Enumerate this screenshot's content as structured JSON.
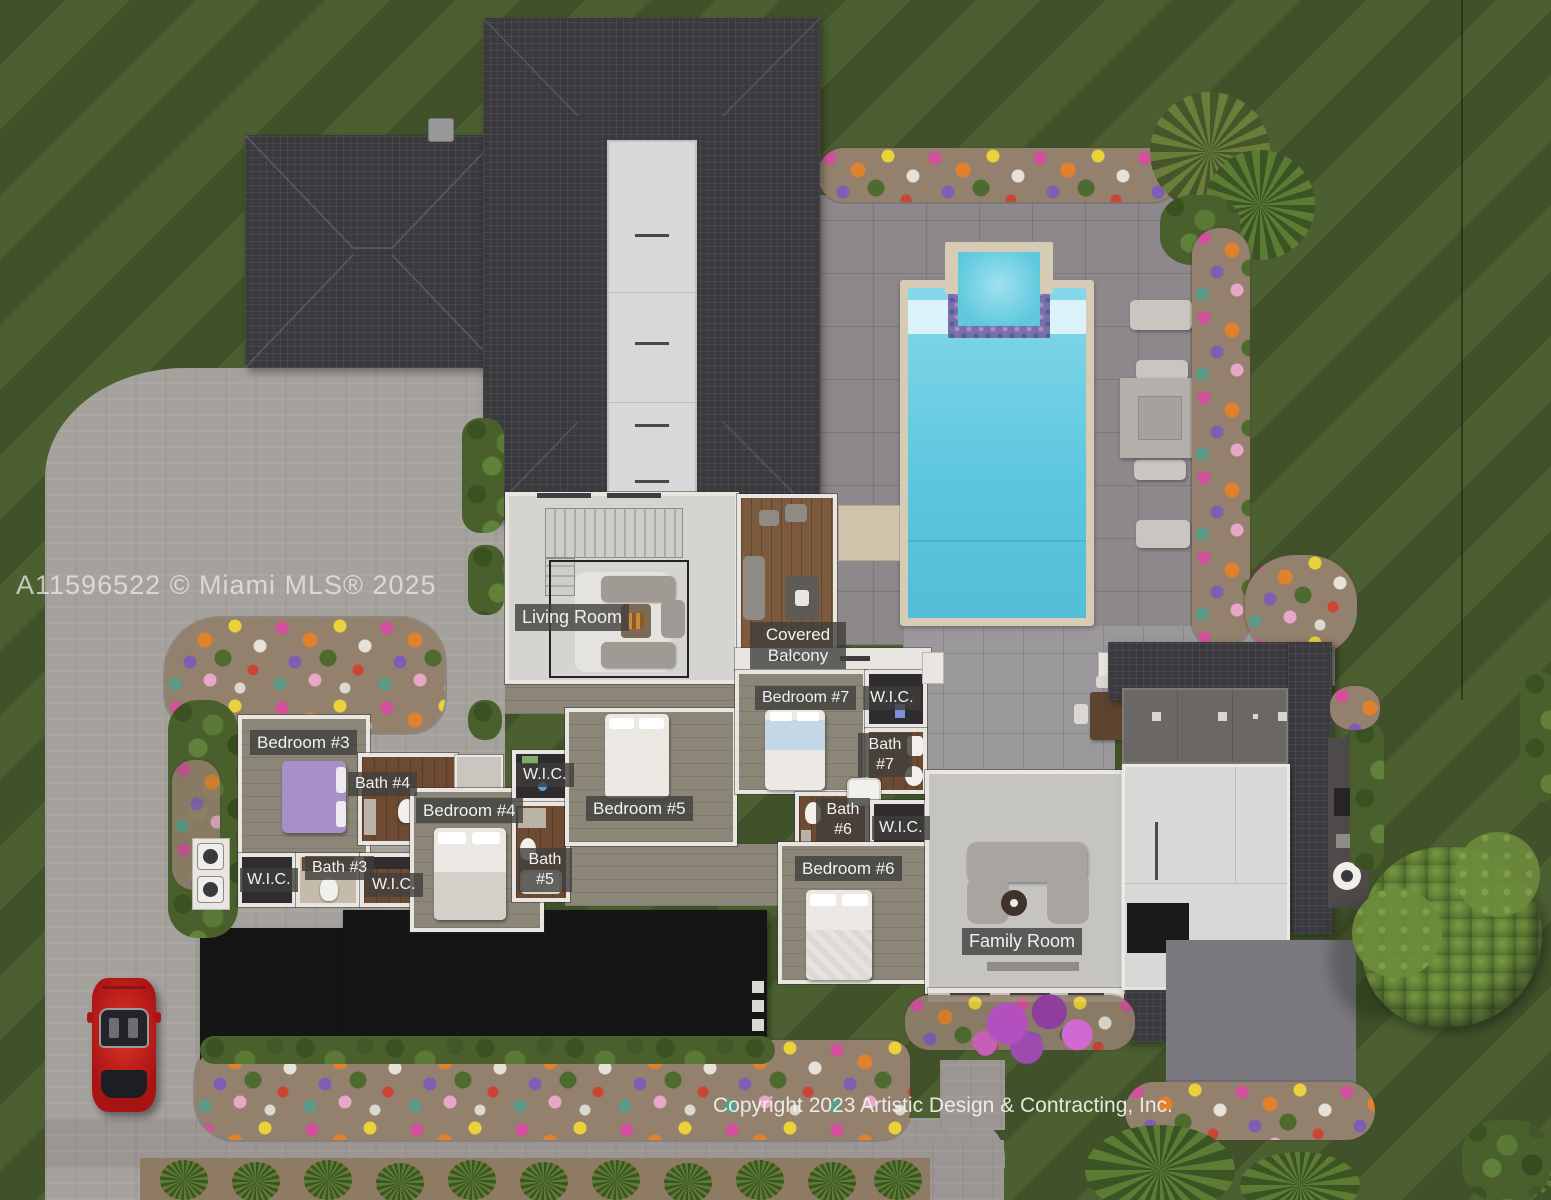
{
  "watermark": {
    "text": "A11596522 © Miami MLS® 2025"
  },
  "footer": {
    "copyright": "Copyright 2023 Artistic Design & Contracting, Inc."
  },
  "plan": {
    "floor_labels": [
      {
        "id": "living-room",
        "text": "Living Room"
      },
      {
        "id": "covered-balcony",
        "text": "Covered Balcony"
      },
      {
        "id": "bedroom-7",
        "text": "Bedroom #7"
      },
      {
        "id": "wic-bedroom-7",
        "text": "W.I.C."
      },
      {
        "id": "bath-7",
        "text": "Bath #7"
      },
      {
        "id": "bedroom-3",
        "text": "Bedroom #3"
      },
      {
        "id": "bath-4",
        "text": "Bath #4"
      },
      {
        "id": "bedroom-4",
        "text": "Bedroom #4"
      },
      {
        "id": "wic-bedroom-4",
        "text": "W.I.C."
      },
      {
        "id": "bedroom-5",
        "text": "Bedroom #5"
      },
      {
        "id": "bath-5",
        "text": "Bath #5"
      },
      {
        "id": "wic-bedroom-3-left",
        "text": "W.I.C."
      },
      {
        "id": "bath-3",
        "text": "Bath #3"
      },
      {
        "id": "wic-bedroom-3-right",
        "text": "W.I.C."
      },
      {
        "id": "bath-6",
        "text": "Bath #6"
      },
      {
        "id": "wic-bedroom-6",
        "text": "W.I.C."
      },
      {
        "id": "bedroom-6",
        "text": "Bedroom #6"
      },
      {
        "id": "family-room",
        "text": "Family Room"
      }
    ]
  },
  "colors": {
    "lawn_dark": "#41522a",
    "lawn_light": "#4b5f31",
    "driveway": "#a5a19d",
    "pool_deck": "#8c888b",
    "roof_tile": "#3a393d",
    "flat_roof_black": "#151515",
    "pool_water": "#6ccde4",
    "pool_coping": "#d6cbb4",
    "label_background": "rgba(64,62,60,0.8)",
    "label_text": "#f2f1ef",
    "sports_car": "#c41c1c"
  }
}
